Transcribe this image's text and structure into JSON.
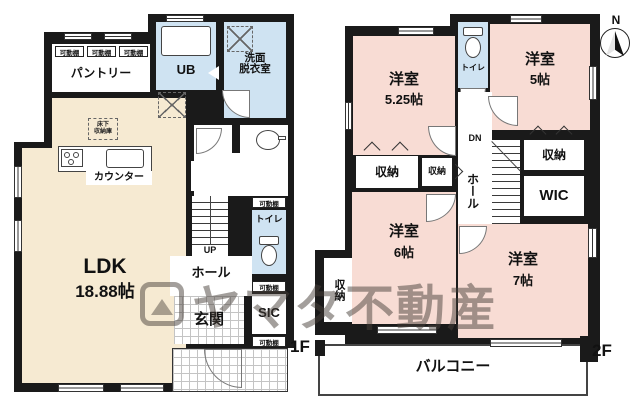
{
  "watermark": {
    "text": "ヤマタ不動産"
  },
  "compass": {
    "north": "N"
  },
  "colors": {
    "wall": "#1a1a1a",
    "ldk": "#f6ead2",
    "wet": "#cfe3f2",
    "bedroom": "#f8dcd4",
    "label": "#111111"
  },
  "floor1": {
    "label": "1F",
    "shelf_label": "可動棚",
    "pantry": "パントリー",
    "ub": "UB",
    "washroom_line1": "洗面",
    "washroom_line2": "脱衣室",
    "ldk_name": "LDK",
    "ldk_size": "18.88帖",
    "counter": "カウンター",
    "underfloor_line1": "床下",
    "underfloor_line2": "収納庫",
    "storage": "収納",
    "stairs_up": "UP",
    "hall": "ホール",
    "toilet": "トイレ",
    "entrance": "玄関",
    "sic": "SIC"
  },
  "floor2": {
    "label": "2F",
    "room525_name": "洋室",
    "room525_size": "5.25帖",
    "room5_name": "洋室",
    "room5_size": "5帖",
    "room6_name": "洋室",
    "room6_size": "6帖",
    "room7_name": "洋室",
    "room7_size": "7帖",
    "toilet": "トイレ",
    "storage": "収納",
    "wic": "WIC",
    "hall": "ホール",
    "stairs_dn": "DN",
    "balcony": "バルコニー"
  }
}
